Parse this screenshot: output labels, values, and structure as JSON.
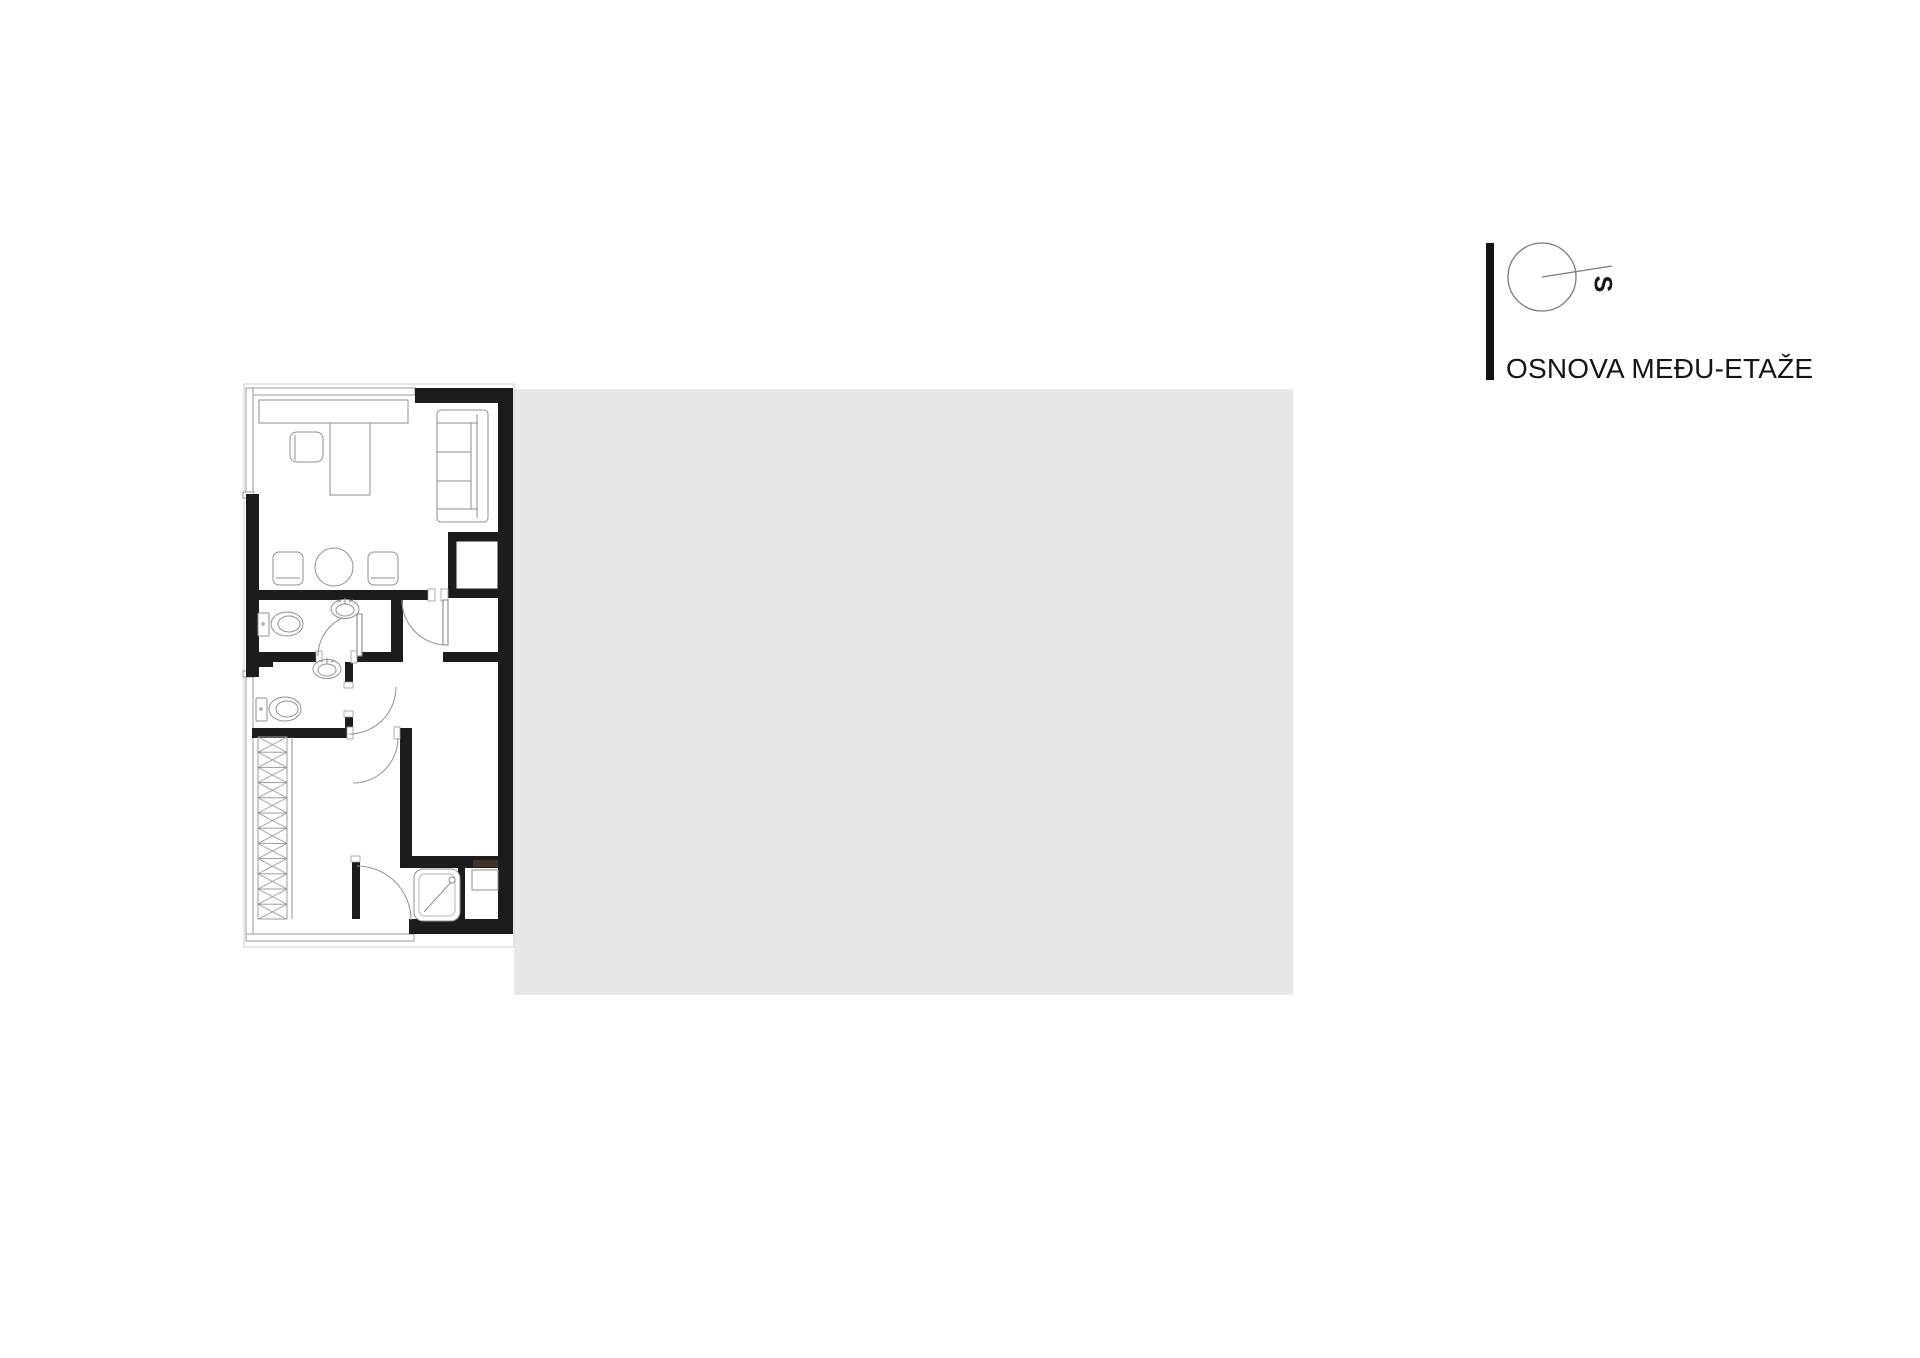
{
  "title_block": {
    "title": "OSNOVA MEĐU-ETAŽE"
  },
  "compass": {
    "label": "S"
  },
  "drawing": {
    "colors": {
      "wall": "#1c1c1c",
      "drawing_line": "#8f8f8f",
      "light_line": "#c0c0c0",
      "shaded_area": "#e7e7e7",
      "accent_bar": "#141414",
      "text": "#151515"
    },
    "fixtures": [
      "desk",
      "desk-chair",
      "sofa",
      "round-table",
      "dining-chair-left",
      "dining-chair-right",
      "washbasin-upper",
      "toilet-upper",
      "washbasin-lower",
      "toilet-lower",
      "wardrobe",
      "shower-tray",
      "installation-shaft"
    ]
  }
}
